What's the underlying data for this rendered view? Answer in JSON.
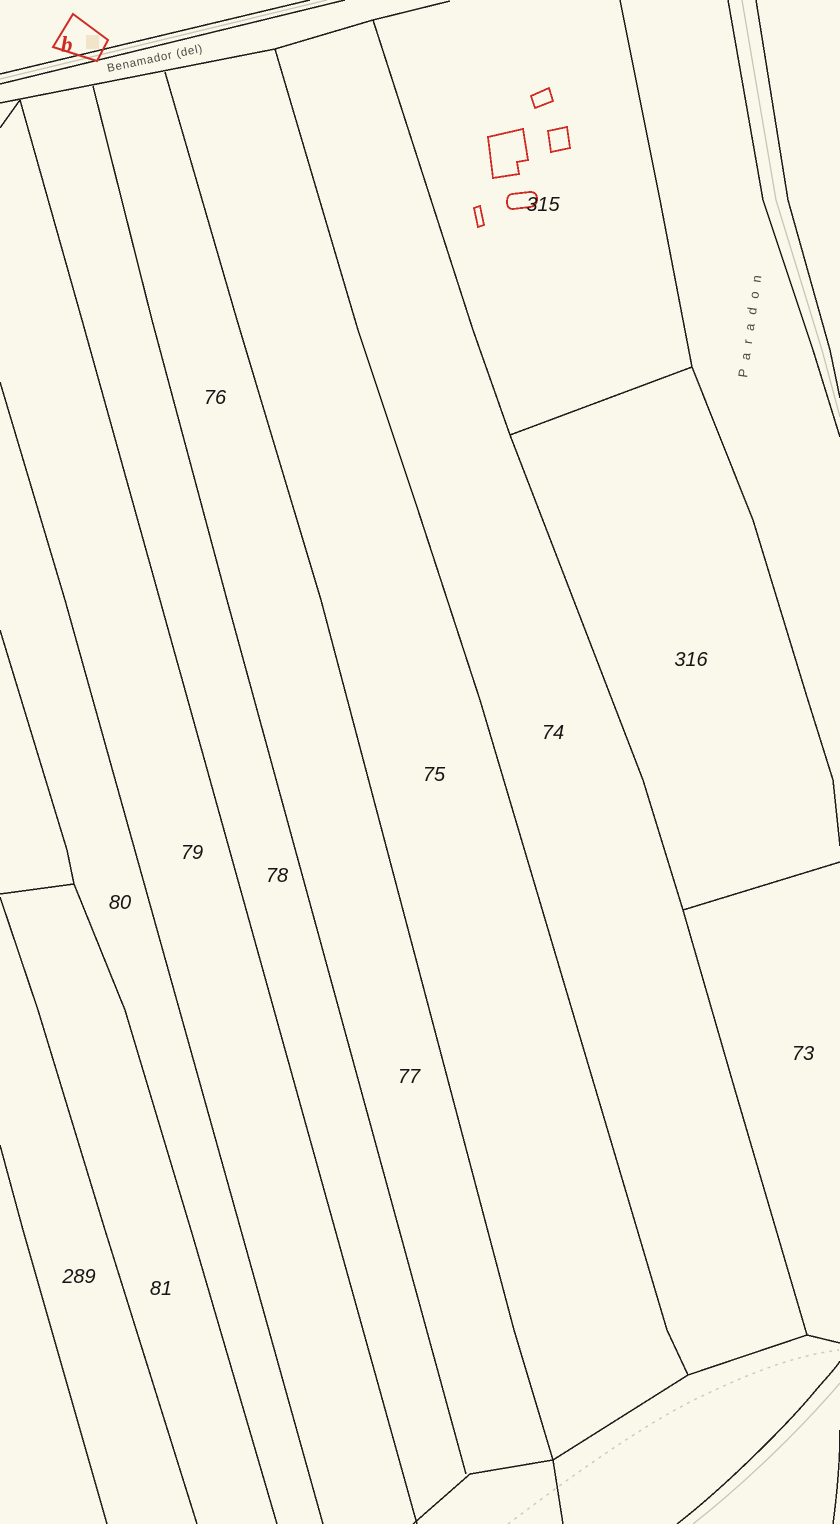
{
  "map": {
    "colors": {
      "background-color": "#f9f8ea",
      "boundary-color": "#1c1c1c",
      "building-color": "#cf2b24",
      "road-casing-color": "#c8c5b6",
      "stream-color": "#ccc9bb",
      "road-label-color": "#4a4a42",
      "parcel-label-color": "#151515",
      "marker-fill-color": "#f2e4c9"
    },
    "roads": [
      {
        "name": "Benamador (del)"
      },
      {
        "name": "Paradon"
      }
    ],
    "parcels": [
      {
        "number": "76"
      },
      {
        "number": "315"
      },
      {
        "number": "316"
      },
      {
        "number": "74"
      },
      {
        "number": "75"
      },
      {
        "number": "79"
      },
      {
        "number": "78"
      },
      {
        "number": "80"
      },
      {
        "number": "77"
      },
      {
        "number": "73"
      },
      {
        "number": "289"
      },
      {
        "number": "81"
      }
    ],
    "marker": {
      "label": "b"
    },
    "edge_label": {
      "text": "1 f"
    }
  }
}
